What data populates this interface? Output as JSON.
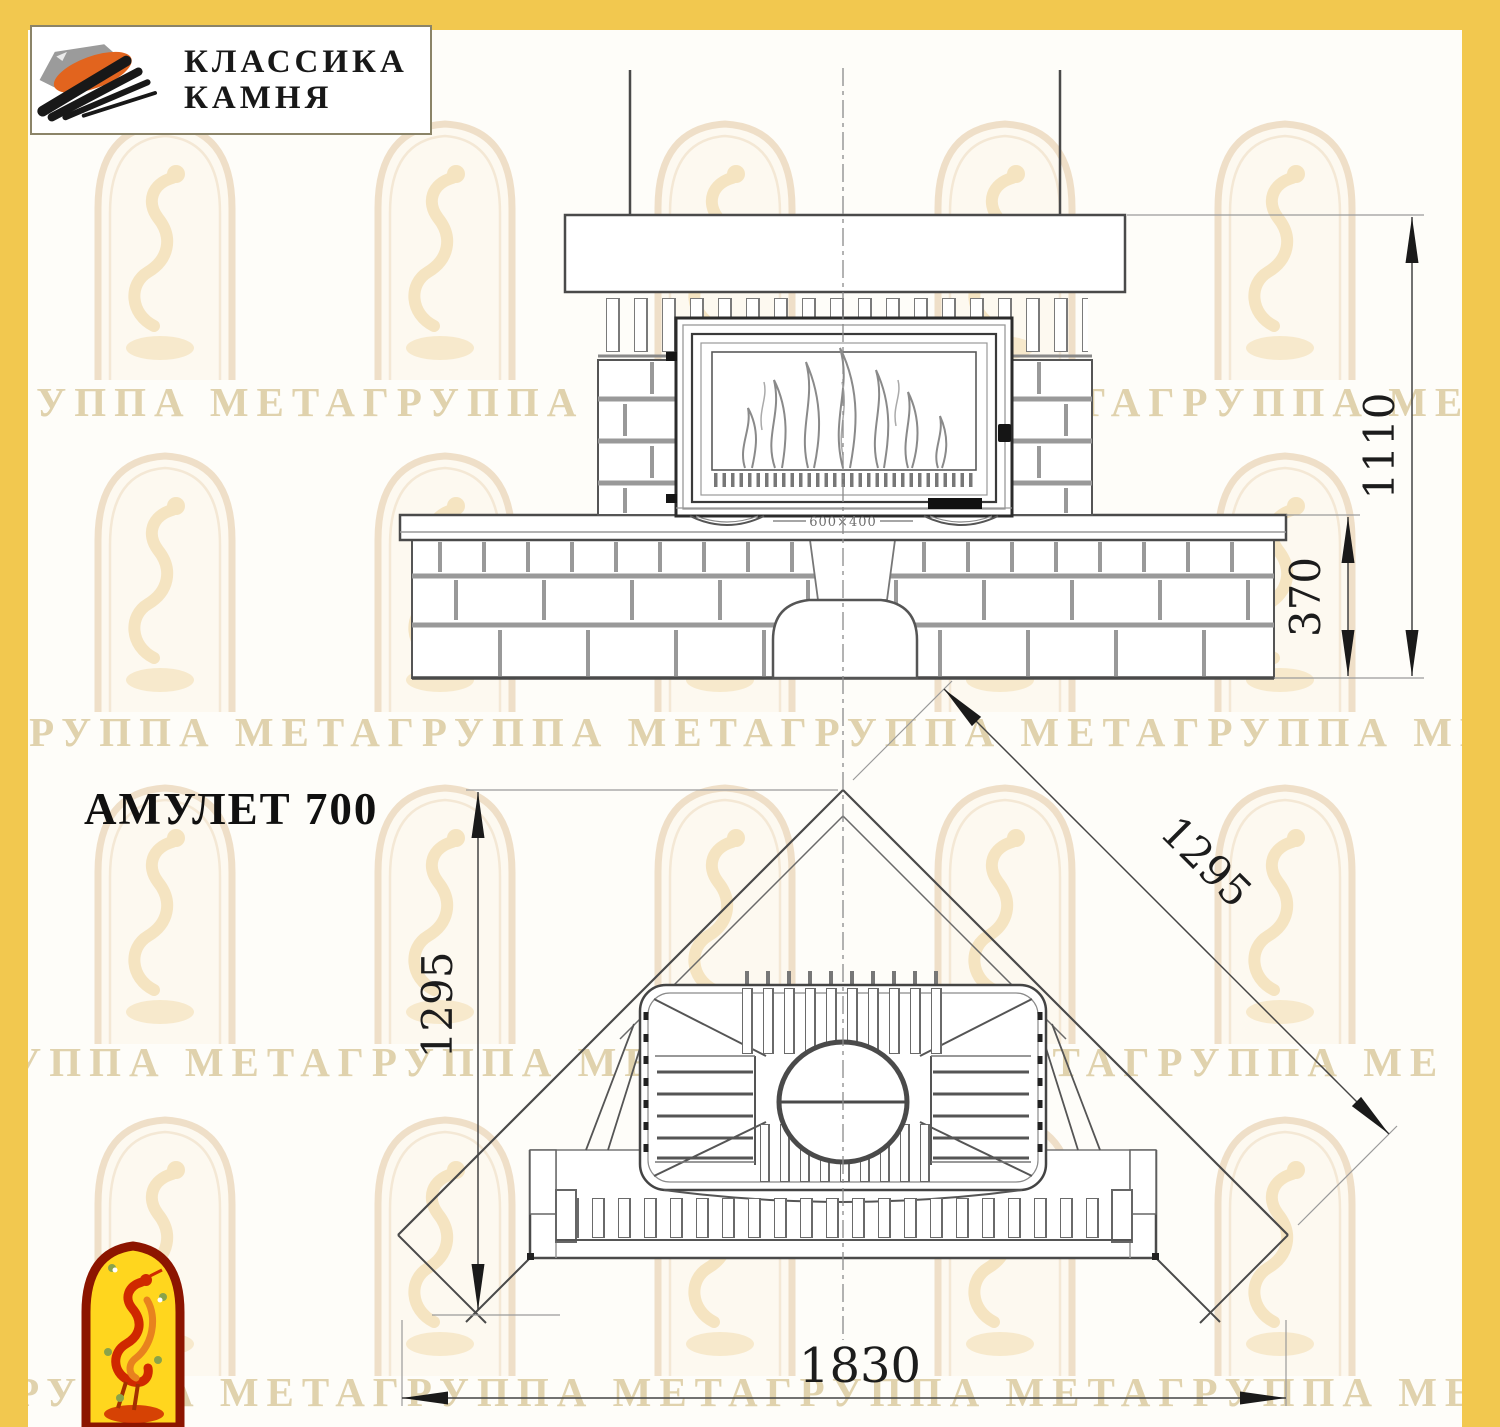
{
  "header": {
    "logo_line1": "КЛАССИКА",
    "logo_line2": "КАМНЯ"
  },
  "title": "АМУЛЕТ 700",
  "watermark_text": "ГРУППА МЕТАГРУППА МЕТАГРУППА МЕТАГРУППА МЕТА",
  "front_view": {
    "label_total_height": "1110",
    "label_bench_height": "370",
    "label_insert_plate": "600×400"
  },
  "plan_view": {
    "label_depth": "1295",
    "label_side": "1295",
    "label_width": "1830"
  },
  "colors": {
    "border_yellow": "#f2c84f",
    "line_dark": "#3c3c3c",
    "mortar_gray": "#9a9a9a",
    "logo_orange": "#e2641e",
    "logo_gray": "#9b9b9b",
    "emblem_red": "#8c1500",
    "emblem_yellow": "#ffd61e",
    "emblem_figure": "#cf2800",
    "watermark_tan": "#c7ae70"
  }
}
